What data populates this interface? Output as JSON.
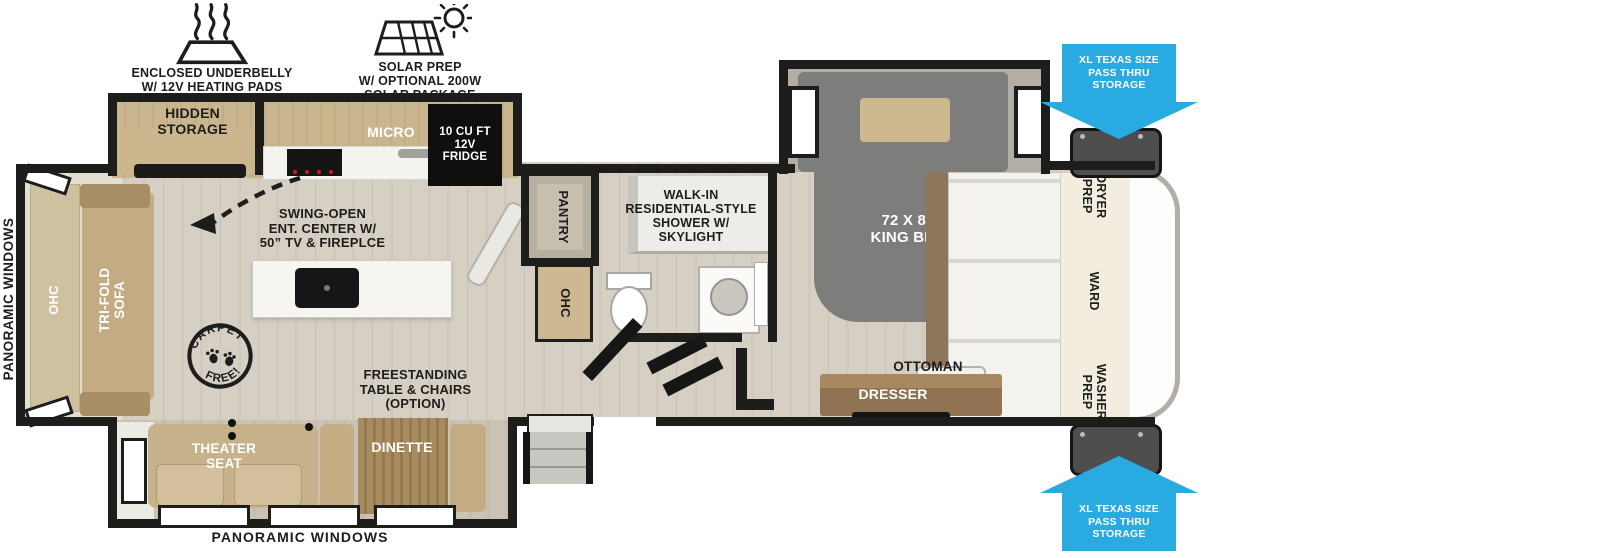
{
  "callouts": {
    "underbelly": "ENCLOSED UNDERBELLY\nW/ 12V HEATING PADS",
    "solar": "SOLAR PREP\nW/ OPTIONAL 200W\nSOLAR PACKAGE",
    "swing_open": "SWING-OPEN\nENT. CENTER W/\n50” TV & FIREPLCE",
    "freestanding": "FREESTANDING\nTABLE & CHAIRS\n(OPTION)",
    "panoramic_windows": "PANORAMIC WINDOWS",
    "pass_thru": "XL TEXAS SIZE\nPASS THRU\nSTORAGE",
    "carpet_free_top": "CARPET",
    "carpet_free_bottom": "FREE!"
  },
  "rooms": {
    "hidden_storage": "HIDDEN\nSTORAGE",
    "micro": "MICRO",
    "fridge": "10 CU FT\n12V\nFRIDGE",
    "pantry": "PANTRY",
    "ohc_bath": "OHC",
    "shower": "WALK-IN\nRESIDENTIAL-STYLE\nSHOWER W/\nSKYLIGHT",
    "king_bed": "72 X 80\nKING BED",
    "ottoman": "OTTOMAN",
    "dresser": "DRESSER",
    "dryer_prep": "DRYER\nPREP",
    "ward": "WARD",
    "washer_prep": "WASHER\nPREP",
    "ohc_rear": "OHC",
    "trifold_sofa": "TRI-FOLD\nSOFA",
    "theater_seat": "THEATER\nSEAT",
    "dinette": "DINETTE"
  },
  "colors": {
    "arrow_blue": "#29abe2",
    "wall_black": "#1d1d1b",
    "floor_wood": "#d5cec2",
    "cabinet_wood": "#c8b48d",
    "bed_gray": "#7d7d7b"
  }
}
